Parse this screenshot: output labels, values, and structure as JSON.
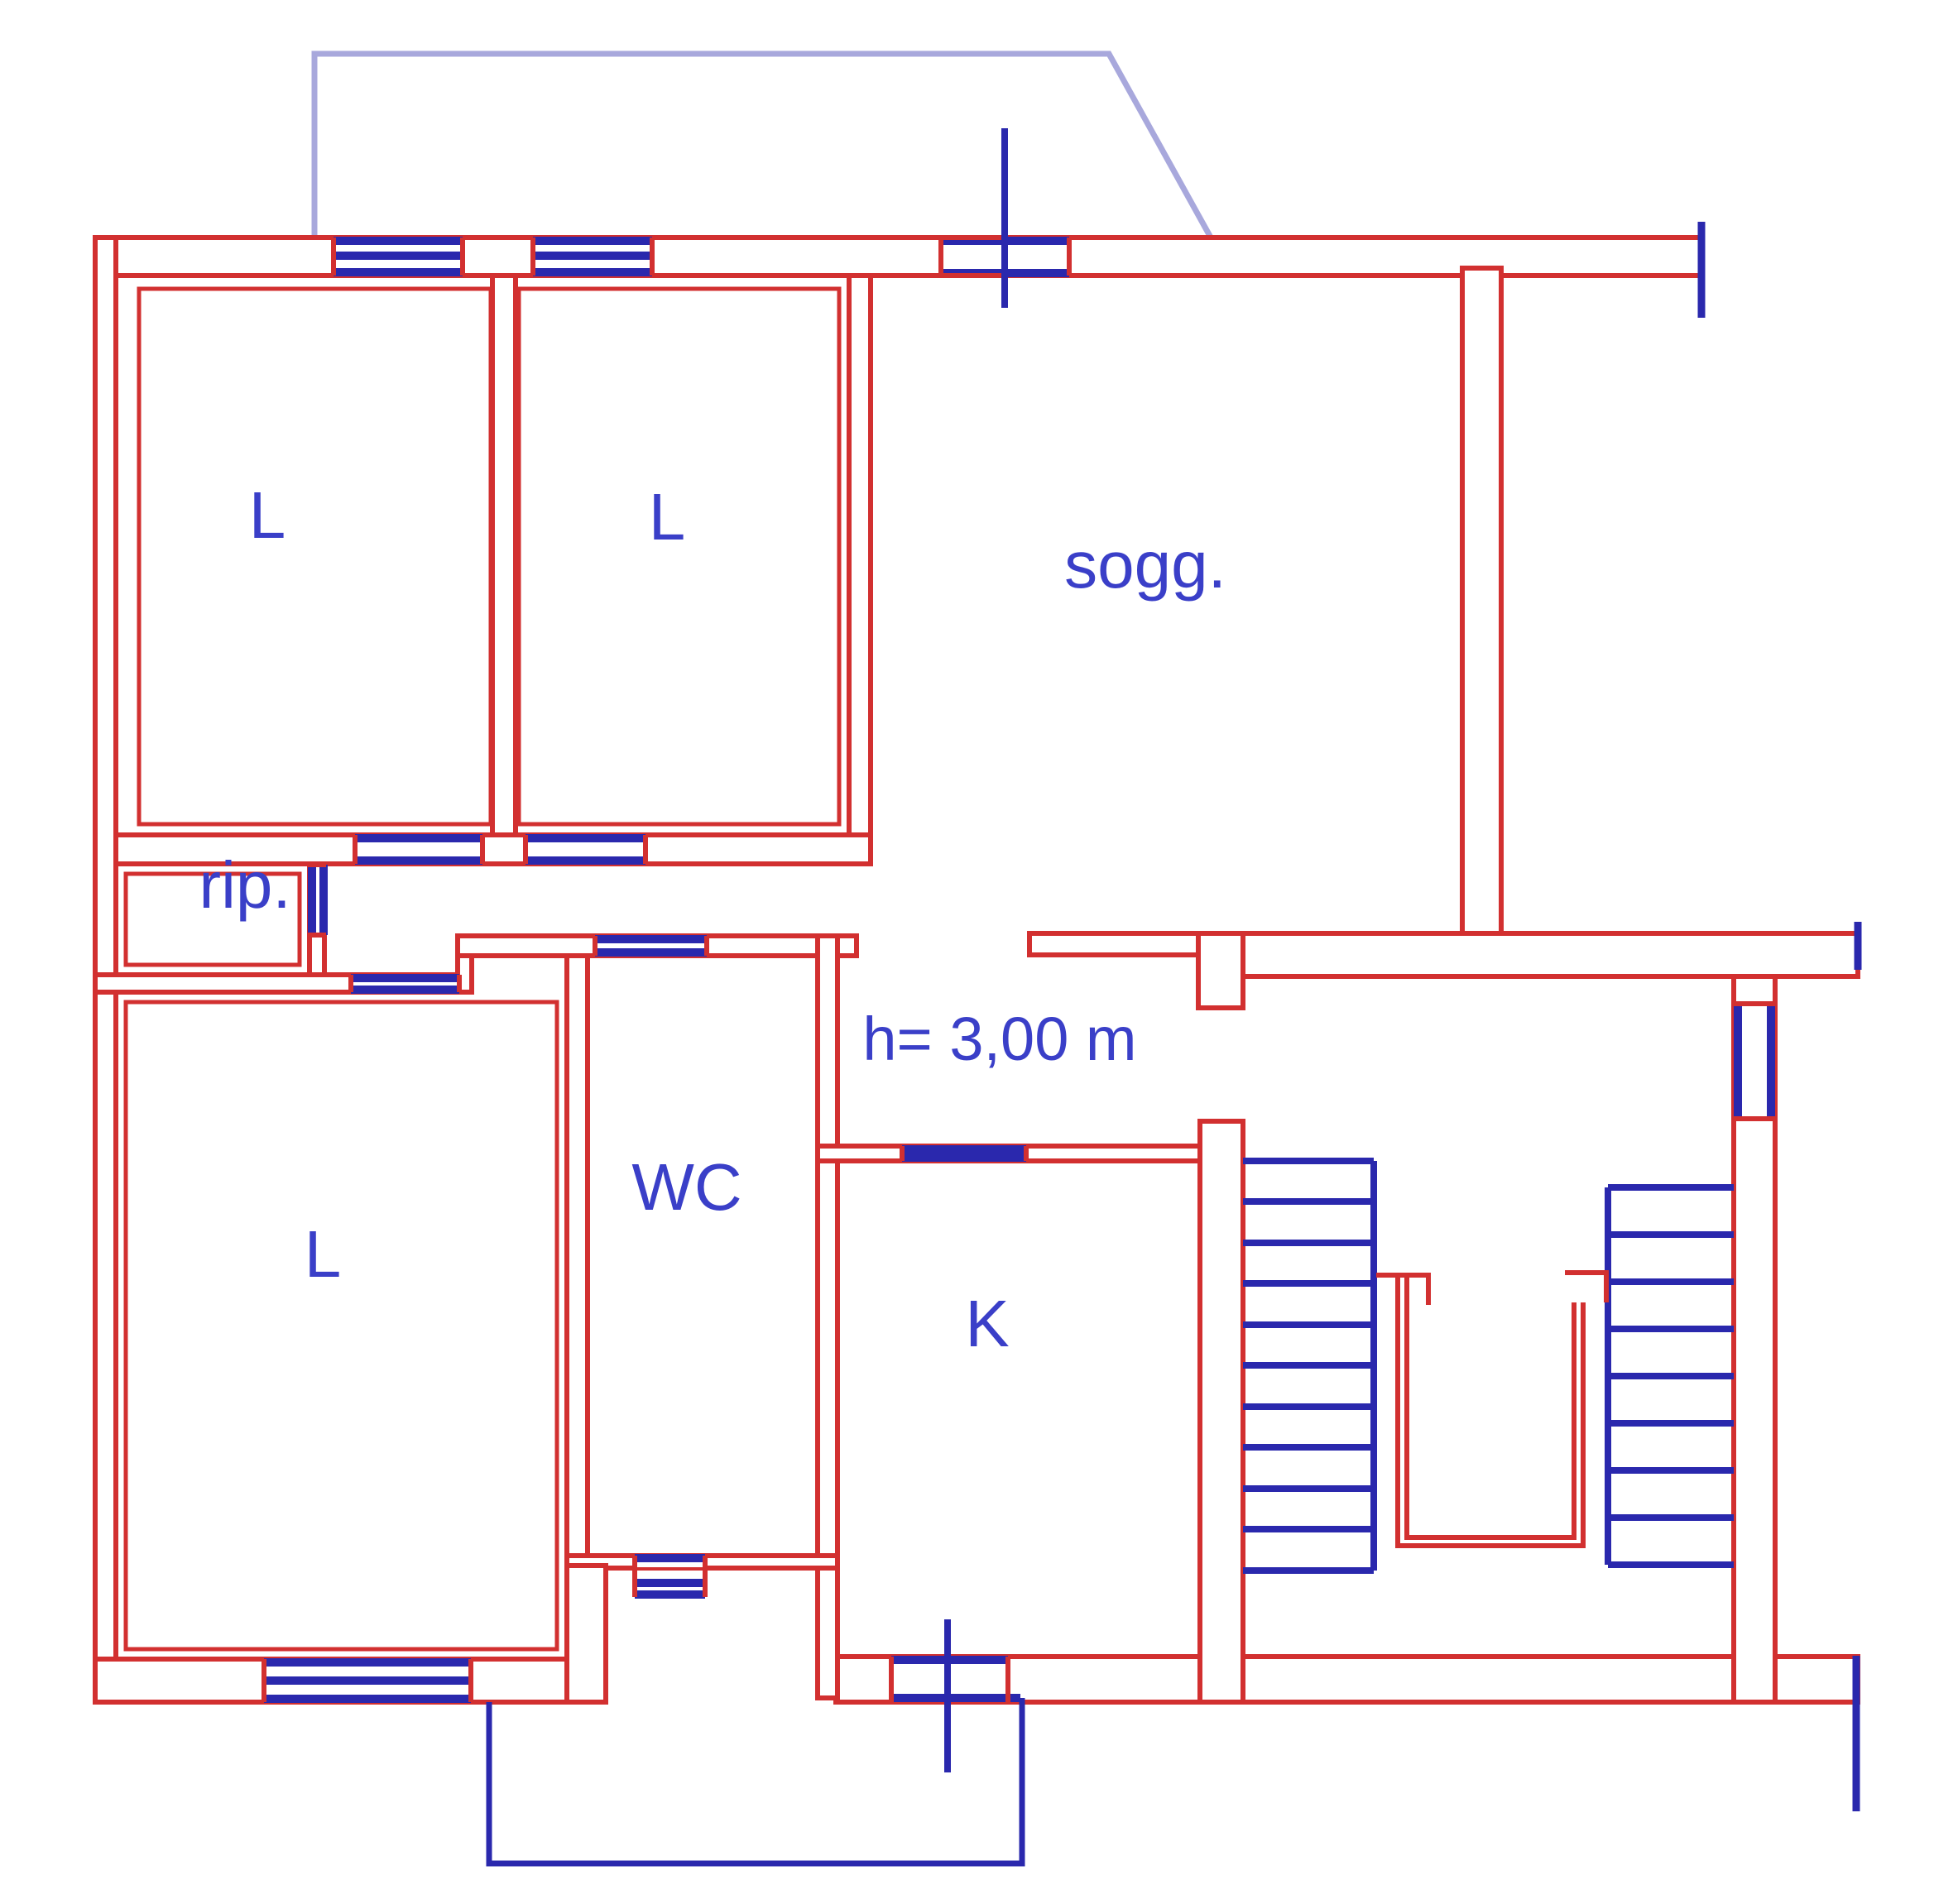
{
  "title": "Apartment floor plan",
  "labels": {
    "bedroom1": "L",
    "bedroom2": "L",
    "living": "sogg.",
    "storage": "rip.",
    "bedroom3": "L",
    "wc": "WC",
    "kitchen": "K",
    "height_note": "h= 3,00 m"
  },
  "colors": {
    "walls": "#d23030",
    "fixtures": "#2a28ad",
    "balcony_line": "#a8a8dc",
    "text": "#3a3fc8",
    "background": "#ffffff"
  }
}
